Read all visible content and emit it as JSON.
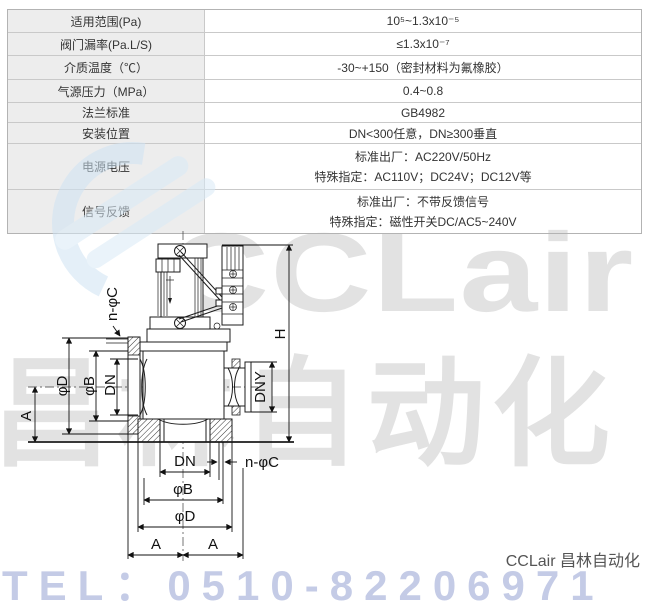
{
  "table": {
    "rows": [
      {
        "label": "适用范围(Pa)",
        "value": "10⁵~1.3x10⁻⁵"
      },
      {
        "label": "阀门漏率(Pa.L/S)",
        "value": "≤1.3x10⁻⁷"
      },
      {
        "label": "介质温度（℃）",
        "value": "-30~+150（密封材料为氟橡胶）"
      },
      {
        "label": "气源压力（MPa）",
        "value": "0.4~0.8"
      },
      {
        "label": "法兰标准",
        "value": "GB4982"
      },
      {
        "label": "安装位置",
        "value": "DN<300任意，DN≥300垂直"
      },
      {
        "label": "电源电压",
        "value_line1": "标准出厂：AC220V/50Hz",
        "value_line2": "特殊指定：AC110V；DC24V；DC12V等"
      },
      {
        "label": "信号反馈",
        "value_line1": "标准出厂：不带反馈信号",
        "value_line2": "特殊指定：磁性开关DC/AC5~240V"
      }
    ]
  },
  "diagram": {
    "labels": {
      "n_phi_c_left": "n-φC",
      "phi_d_left": "φD",
      "phi_b_left": "φB",
      "dn_left": "DN",
      "a_left": "A",
      "h": "H",
      "dny": "DNY",
      "dn_bottom": "DN",
      "n_phi_c_bottom": "n-φC",
      "phi_b_bottom": "φB",
      "phi_d_bottom": "φD",
      "a_bottom_left": "A",
      "a_bottom_right": "A"
    }
  },
  "watermarks": {
    "brand_latin": "CCLair",
    "brand_cn": "昌林自动化",
    "tel": "TEL：0510-82206971"
  },
  "footer": {
    "brand": "CCLair 昌林自动化"
  },
  "colors": {
    "table_border": "#c9c9c9",
    "label_cell_bg": "#ededed",
    "text": "#333333",
    "watermark_gray": "rgba(50,50,50,0.14)",
    "watermark_blue": "#cfe3f3",
    "tel_blue": "rgba(125,140,200,0.45)"
  }
}
